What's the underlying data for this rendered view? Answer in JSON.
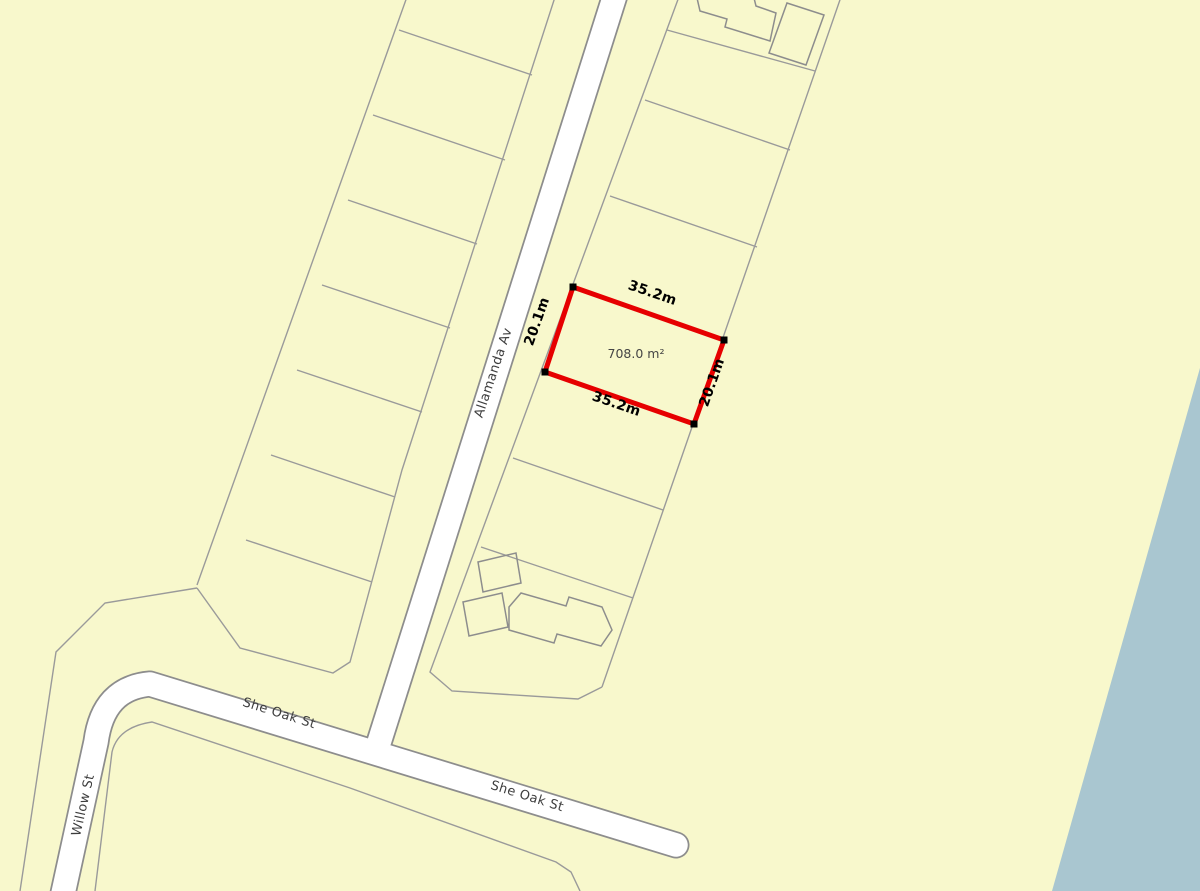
{
  "map": {
    "colors": {
      "land": "#f8f8cc",
      "water": "#a9c6d0",
      "road_fill": "#ffffff",
      "road_casing": "#8d8d8d",
      "parcel_line": "#9a9a9a",
      "building_line": "#8d8d8d",
      "highlight": "#e60000",
      "marker": "#000000",
      "street_text": "#3d3d3d",
      "dim_text": "#000000",
      "area_text": "#454545"
    },
    "streets": [
      {
        "name": "Allamanda Av"
      },
      {
        "name": "She Oak St"
      },
      {
        "name": "She Oak St"
      },
      {
        "name": "Willow St"
      }
    ],
    "parcel": {
      "area": "708.0 m²",
      "dim_top": "35.2m",
      "dim_bottom": "35.2m",
      "dim_left": "20.1m",
      "dim_right": "20.1m",
      "frontage_m": "35.2",
      "depth_m": "20.1"
    }
  },
  "geometry": {
    "water": "M1200,368 L1200,891 L1052,891 Z",
    "road_allamanda": "M616,-8 L376,752",
    "road_sheoak": "M62,898 L96,742 Q103,688 150,684 L676,845",
    "parcels_west": "M408,-6 L197,585 M556,-6 L402,470 L350,662 L333,673 L240,648 L197,588 M399,30 L532,75 M373,115 L505,160 M348,200 L477,244 M322,285 L450,328 M297,370 L422,412 M271,455 L395,497 M246,540 L372,582",
    "parcels_bend": "M197,588 L105,603 L56,652 L20,891",
    "parcels_south": "M95,891 L112,752 Q118,727 152,722 L350,788 L556,862 L571,872 L580,891",
    "parcels_east": "M680,-6 L430,672 L452,691 L578,699 L602,687 M842,-6 L602,687 M667,30 L815,71 M645,100 L790,150 M610,196 L757,247 M513,458 L663,510 M481,547 L633,598",
    "buildings": "M697,-2 L700,11 L727,19 L725,27 L770,41 L776,13 L756,6 L754,-2 Z M787,3 L824,15 L806,65 L769,53 Z M478,562 L516,553 L521,583 L483,592 Z M463,602 L502,593 L508,627 L469,636 Z M509,607 L521,593 L566,606 L569,597 L602,607 L612,630 L601,646 L557,634 L554,643 L509,630 Z",
    "highlight_outline": "M573,287 L724,340 L694,424 L545,372 Z",
    "corner_markers": "M569.5,283.5h7v7h-7z M720.5,336.5h7v7h-7z M690.5,420.5h7v7h-7z M541.5,368.5h7v7h-7z"
  }
}
